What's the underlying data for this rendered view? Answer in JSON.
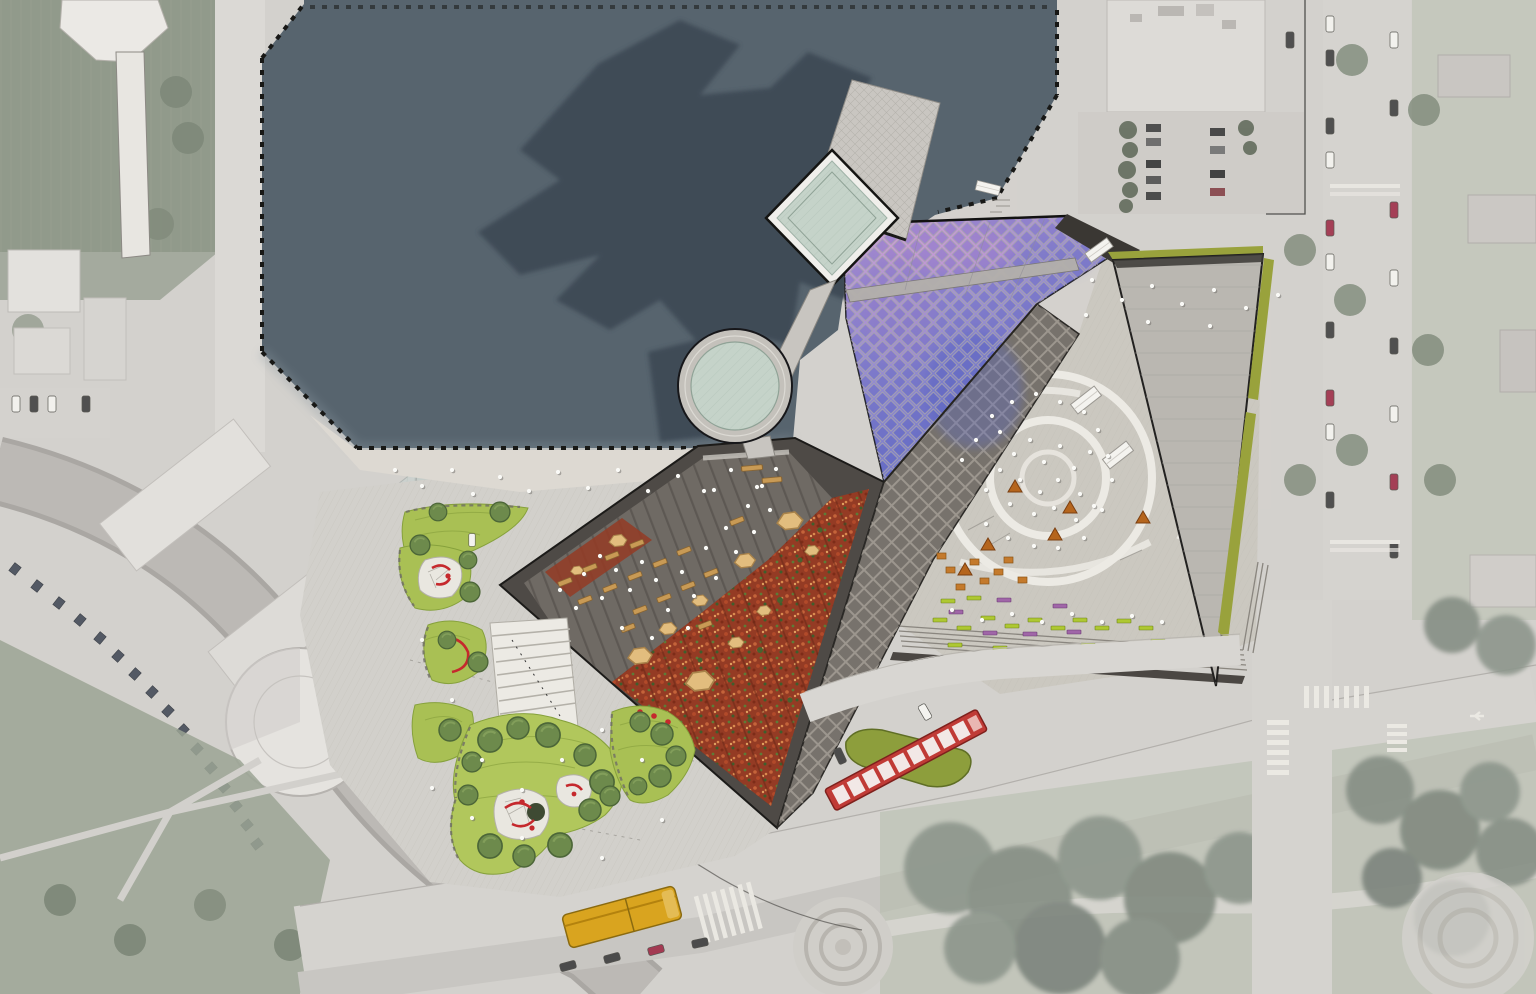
{
  "scene": {
    "type": "aerial-site-plan-rendering",
    "description": "Top-down architectural master plan rendering of a lakefront cultural plaza, drawn over a desaturated aerial photograph of the surrounding blocks",
    "view": "plan (top-down)"
  },
  "palette": {
    "base": "#d3d1cd",
    "water": "#57646e",
    "shadow": "#3e4a54",
    "lawnFaded": "#8f9889",
    "lawnBright": "#a9c054",
    "treeGreen": "#6d8a4c",
    "roofLight": "#c9c6c1",
    "glass": "#c5d3c9",
    "purplePink": "#cf9fd6",
    "purpleBlue": "#6b74c8",
    "plazaDark": "#6f6a64",
    "rim": "#4e4a46",
    "redGarden": "#943b24",
    "benchTan": "#c89a55",
    "boulder": "#e2bd7e",
    "plazaLight": "#cbc8c0",
    "pathWhite": "#eceae4",
    "roofTriangle": "#bab7b1",
    "olive": "#99a23c",
    "tramRed": "#c03b36",
    "busYellow": "#d9a41f",
    "benchGreen": "#aec832",
    "benchPurple": "#a066a8",
    "kioskOrange": "#b5651d",
    "road": "#d6d4d0",
    "ink": "#1c1b19"
  },
  "regions": {
    "lake": {
      "name": "harbor-basin",
      "edge": "dashed pile boardwalk with red tick marks",
      "color": "#57646e"
    },
    "building_shadow": {
      "name": "tower-shadow-on-water",
      "color": "#3e4a54"
    },
    "scaled_roof": {
      "name": "iridescent-scaled-roof",
      "colors": [
        "#cf9fd6",
        "#6b74c8"
      ],
      "planes": 2
    },
    "skylight_diamond": {
      "name": "square-glass-skylight",
      "color": "#c5d3c9"
    },
    "skylight_round": {
      "name": "round-glass-oculus",
      "color": "#c5d3c9"
    },
    "wing_roof": {
      "name": "crosshatched-roof-wing",
      "color": "#c9c6c1"
    },
    "amphitheater": {
      "name": "terraced-dark-granite-plaza",
      "benches": 18,
      "color": "#6f6a64"
    },
    "red_meadow": {
      "name": "red-sedum-planted-slope",
      "color": "#943b24"
    },
    "sloped_band": {
      "name": "lattice-textured-sloped-roof-band",
      "color": "#77726c"
    },
    "event_plaza": {
      "name": "light-paved-event-plaza",
      "features": [
        "concentric white path circles",
        "market stalls",
        "food kiosks",
        "scattered crowd"
      ]
    },
    "grandstand_roof": {
      "name": "concrete-roof-wedge",
      "color": "#bab7b1",
      "edge_strips": "#99a23c"
    },
    "playground": {
      "name": "play-mounds-park",
      "lawns": 6,
      "trees": 25,
      "play_surfaces": "white voronoi with red equipment"
    },
    "grand_stair": {
      "name": "wide-white-stair",
      "color": "#eceae4"
    },
    "tram_stop": {
      "name": "tram-platform-island",
      "color": "#8d9e3c"
    },
    "campus": {
      "name": "faded-museum-campus",
      "features": [
        "glass-roof halls",
        "white dome",
        "curved service road with panel strip"
      ]
    },
    "streets": {
      "name": "street-grid",
      "crosswalks": 6,
      "roundabouts": 2
    }
  },
  "vehicles": [
    {
      "name": "red-tram",
      "color": "#c03b36"
    },
    {
      "name": "yellow-articulated-bus",
      "color": "#d9a41f"
    },
    {
      "name": "white-cars",
      "count": 3
    },
    {
      "name": "market-trucks",
      "count": 2,
      "color": "#f4f3ef"
    },
    {
      "name": "street-parked-cars",
      "count": 20
    },
    {
      "name": "lot-parked-cars",
      "count": 9
    }
  ],
  "counts": {
    "people_dots": 103,
    "park_trees": 25,
    "amphitheater_benches": 18,
    "plaza_benches_green": 18,
    "plaza_benches_purple": 6,
    "food_kiosks": 6,
    "market_stalls": 2,
    "boulders": 11,
    "crosswalks": 6
  }
}
